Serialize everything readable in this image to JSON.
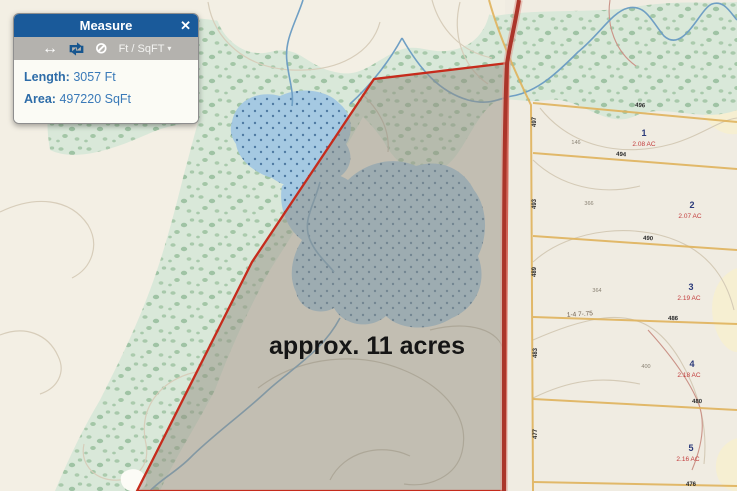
{
  "measure_panel": {
    "title": "Measure",
    "close_icon": "✕",
    "distance_tool_icon": "↔",
    "clear_tool_icon": "⊘",
    "units_label": "Ft / SqFT",
    "units_caret": "▾",
    "length_label": "Length:",
    "length_value": "3057 Ft",
    "area_label": "Area:",
    "area_value": "497220 SqFt"
  },
  "map": {
    "area_annotation": "approx. 11 acres",
    "parcels": [
      {
        "number": "1",
        "acreage": "2.08 AC"
      },
      {
        "number": "2",
        "acreage": "2.07 AC"
      },
      {
        "number": "3",
        "acreage": "2.19 AC"
      },
      {
        "number": "4",
        "acreage": "2.18 AC"
      },
      {
        "number": "5",
        "acreage": "2.16 AC"
      }
    ],
    "boundary_labels": [
      "496",
      "494",
      "490",
      "486",
      "480",
      "476"
    ],
    "edge_labels": [
      "497",
      "493",
      "489",
      "483",
      "477"
    ],
    "contour_labels": [
      "146",
      "366",
      "364",
      "400"
    ],
    "dimension_label": "1-4 7-.75",
    "colors": {
      "panel_header": "#1a5a9a",
      "measurement_outline": "#c62b1c",
      "measurement_fill": "#97918a",
      "road": "#ab352a",
      "water": "#a5c9e2",
      "stream": "#6f9fc4",
      "vegetation": "#d9e8d9",
      "parcel_line": "#e0b35c",
      "parcel_number": "#2b3a7a",
      "parcel_acreage": "#c23b3b"
    }
  }
}
